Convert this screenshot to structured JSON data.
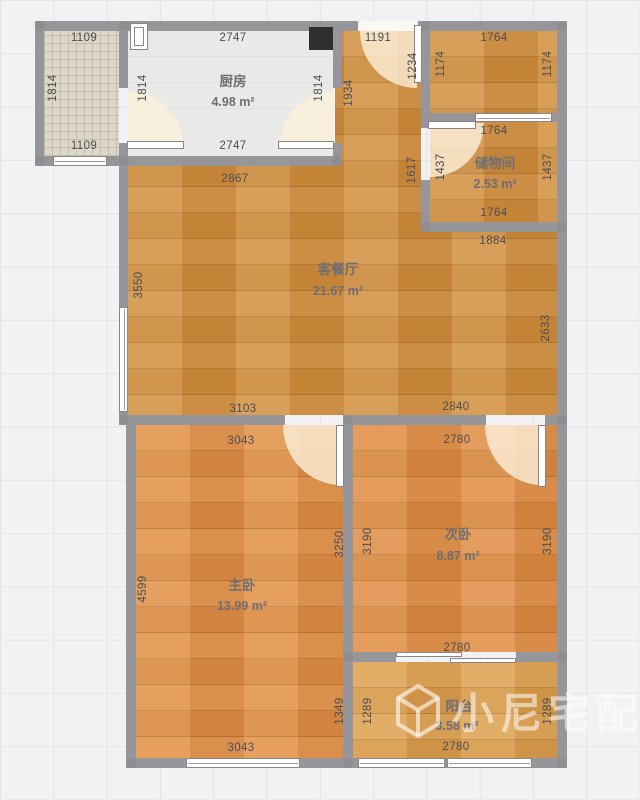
{
  "rooms": {
    "kitchen": {
      "name": "厨房",
      "area": "4.98 m²"
    },
    "storage": {
      "name": "储物间",
      "area": "2.53 m²"
    },
    "living": {
      "name": "客餐厅",
      "area": "21.67 m²"
    },
    "master": {
      "name": "主卧",
      "area": "13.99 m²"
    },
    "second": {
      "name": "次卧",
      "area": "8.87 m²"
    },
    "balcony": {
      "name": "阳台",
      "area": "3.58 m²"
    }
  },
  "dims": {
    "hatch_top": "1109",
    "hatch_left": "1814",
    "hatch_bottom": "1109",
    "kitchen_left": "1814",
    "kitchen_top": "2747",
    "kitchen_right": "1814",
    "kitchen_bottom": "2747",
    "entry_top": "1191",
    "entry_left": "1934",
    "entry_right": "1234",
    "entry_left_lower": "1617",
    "troom_top": "1764",
    "troom_left": "1174",
    "troom_right": "1174",
    "storage_top": "1764",
    "storage_left": "1437",
    "storage_right": "1437",
    "storage_bottom": "1764",
    "storage_below": "1884",
    "living_top": "2867",
    "living_left": "3550",
    "living_right": "2633",
    "living_bottom_left": "3103",
    "living_bottom_right": "2840",
    "master_top": "3043",
    "master_left": "4599",
    "master_right": "3250",
    "master_bottom": "3043",
    "master_right_lower": "1349",
    "second_top": "2780",
    "second_left": "3190",
    "second_right": "3190",
    "second_bottom": "2780",
    "balcony_left": "1289",
    "balcony_right": "1289",
    "balcony_bottom": "2780"
  },
  "watermark": {
    "text": "小尼宅配"
  },
  "colors": {
    "wall": "#95959a",
    "wood_living": "#d08e3e",
    "wood_master": "#e08f47",
    "wood_second": "#dd8b43",
    "wood_balcony": "#dca04f",
    "kitchen_floor": "#e9e9e7",
    "hatch_floor": "#dcd7c9",
    "door_fan": "#fcf0db",
    "background_grid": "#f2f2f4"
  }
}
